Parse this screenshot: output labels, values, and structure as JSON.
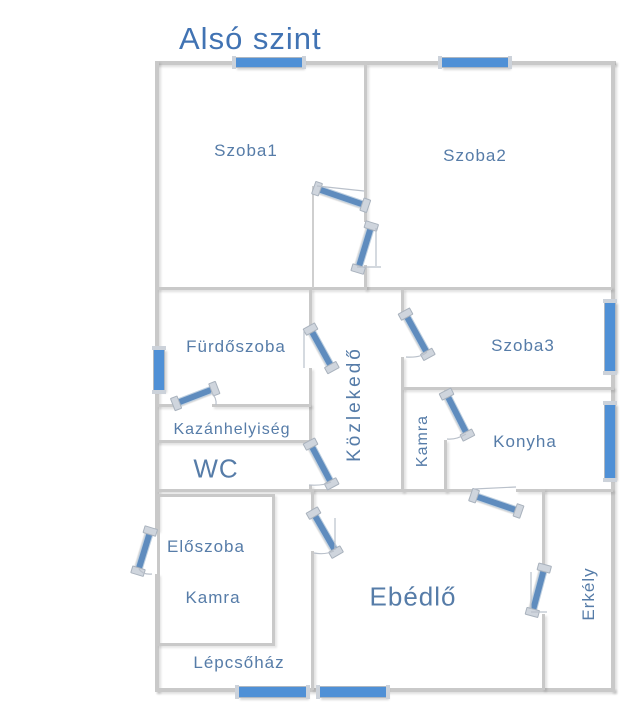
{
  "title": "Alsó szint",
  "floor_plan": {
    "rooms": [
      {
        "name": "szoba1",
        "label": "Szoba1"
      },
      {
        "name": "szoba2",
        "label": "Szoba2"
      },
      {
        "name": "furdoszoba",
        "label": "Fürdőszoba"
      },
      {
        "name": "kozlekedo",
        "label": "Közlekedő"
      },
      {
        "name": "szoba3",
        "label": "Szoba3"
      },
      {
        "name": "kazanhelyiseg",
        "label": "Kazánhelyiség"
      },
      {
        "name": "wc",
        "label": "WC"
      },
      {
        "name": "kamra-felso",
        "label": "Kamra"
      },
      {
        "name": "konyha",
        "label": "Konyha"
      },
      {
        "name": "eloszoba",
        "label": "Előszoba"
      },
      {
        "name": "kamra-also",
        "label": "Kamra"
      },
      {
        "name": "ebedlo",
        "label": "Ebédlő"
      },
      {
        "name": "erkely",
        "label": "Erkély"
      },
      {
        "name": "lepcsohaz",
        "label": "Lépcsőház"
      }
    ],
    "windows": [
      "szoba1-top",
      "szoba2-top",
      "furdoszoba-left",
      "szoba3-right",
      "konyha-right",
      "lepcsohaz-bottom",
      "ebedlo-bottom"
    ],
    "doors": [
      "szoba1",
      "szoba2",
      "furdoszoba",
      "kazanhelyiseg",
      "szoba3",
      "kamra",
      "wc",
      "ebedlo-hall",
      "entrance",
      "konyha-ebedlo",
      "erkely"
    ],
    "colors": {
      "title": "#4173b3",
      "label": "#567ca8",
      "wall": "#c9c9c9",
      "window": "#4f90d6",
      "door": "#5f8cbe"
    }
  }
}
